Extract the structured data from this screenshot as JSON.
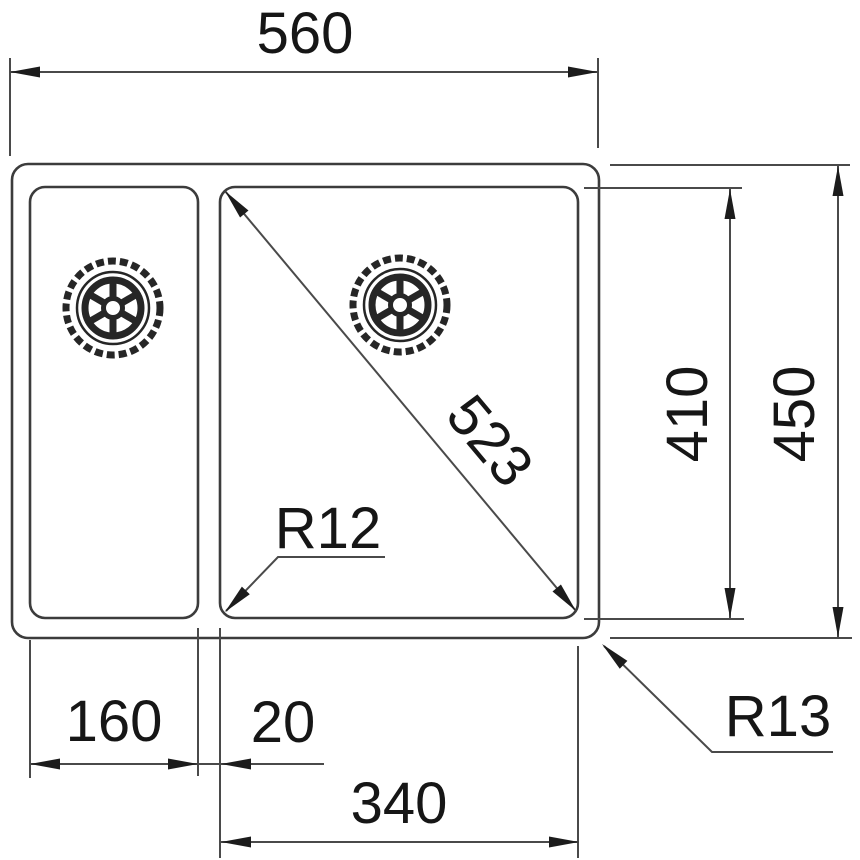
{
  "drawing": {
    "title": "Undermount double-bowl sink - dimensioned top view technical drawing",
    "units": "mm",
    "labels": {
      "overall_width": "560",
      "bowl_diagonal": "523",
      "bowl_depth": "410",
      "overall_depth": "450",
      "bowl_corner_radius": "R12",
      "outer_corner_radius": "R13",
      "small_bowl_width": "160",
      "divider_gap": "20",
      "large_bowl_width": "340"
    },
    "icons": {
      "left_drain": "drain-strainer-icon",
      "right_drain": "drain-strainer-icon"
    },
    "colors": {
      "background": "#ffffff",
      "object_line": "#3c3c3c",
      "dimension_line": "#4a4a4a",
      "text": "#161616",
      "arrowhead": "#1c1c1c"
    }
  }
}
